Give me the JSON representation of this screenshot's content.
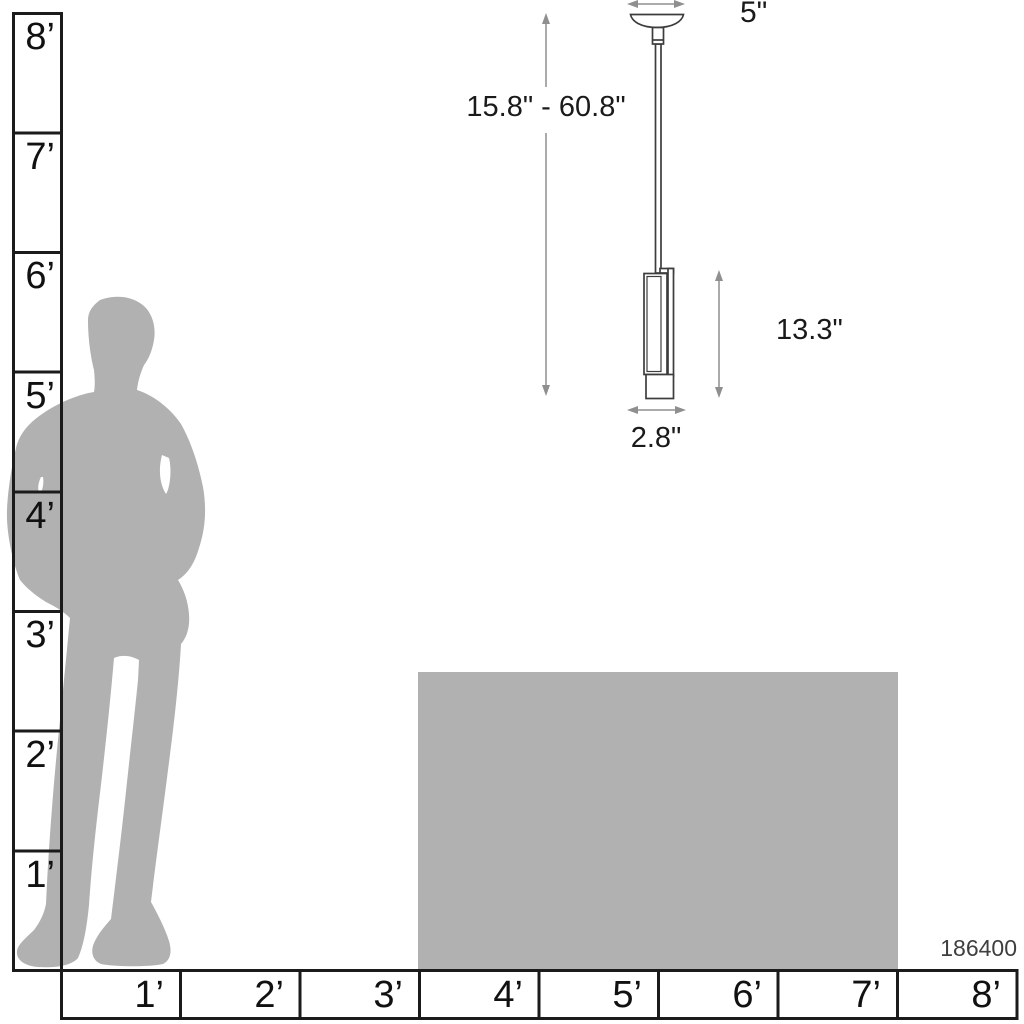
{
  "product": {
    "model_number": "186400"
  },
  "dimensions": {
    "canopy_width": "5\"",
    "height_range": "15.8\" - 60.8\"",
    "fixture_height": "13.3\"",
    "fixture_width": "2.8\""
  },
  "rulers": {
    "unit": "feet",
    "vertical": {
      "labels": [
        "8’",
        "7’",
        "6’",
        "5’",
        "4’",
        "3’",
        "2’",
        "1’"
      ]
    },
    "horizontal": {
      "labels": [
        "1’",
        "2’",
        "3’",
        "4’",
        "5’",
        "6’",
        "7’",
        "8’"
      ]
    }
  },
  "colors": {
    "silhouette": "#b1b1b1",
    "counter": "#b1b1b1",
    "ruler_line": "#1b1b1b",
    "fixture_line": "#3d3d3d",
    "arrow": "#8f8f8f",
    "highlight": "#ffffff"
  }
}
